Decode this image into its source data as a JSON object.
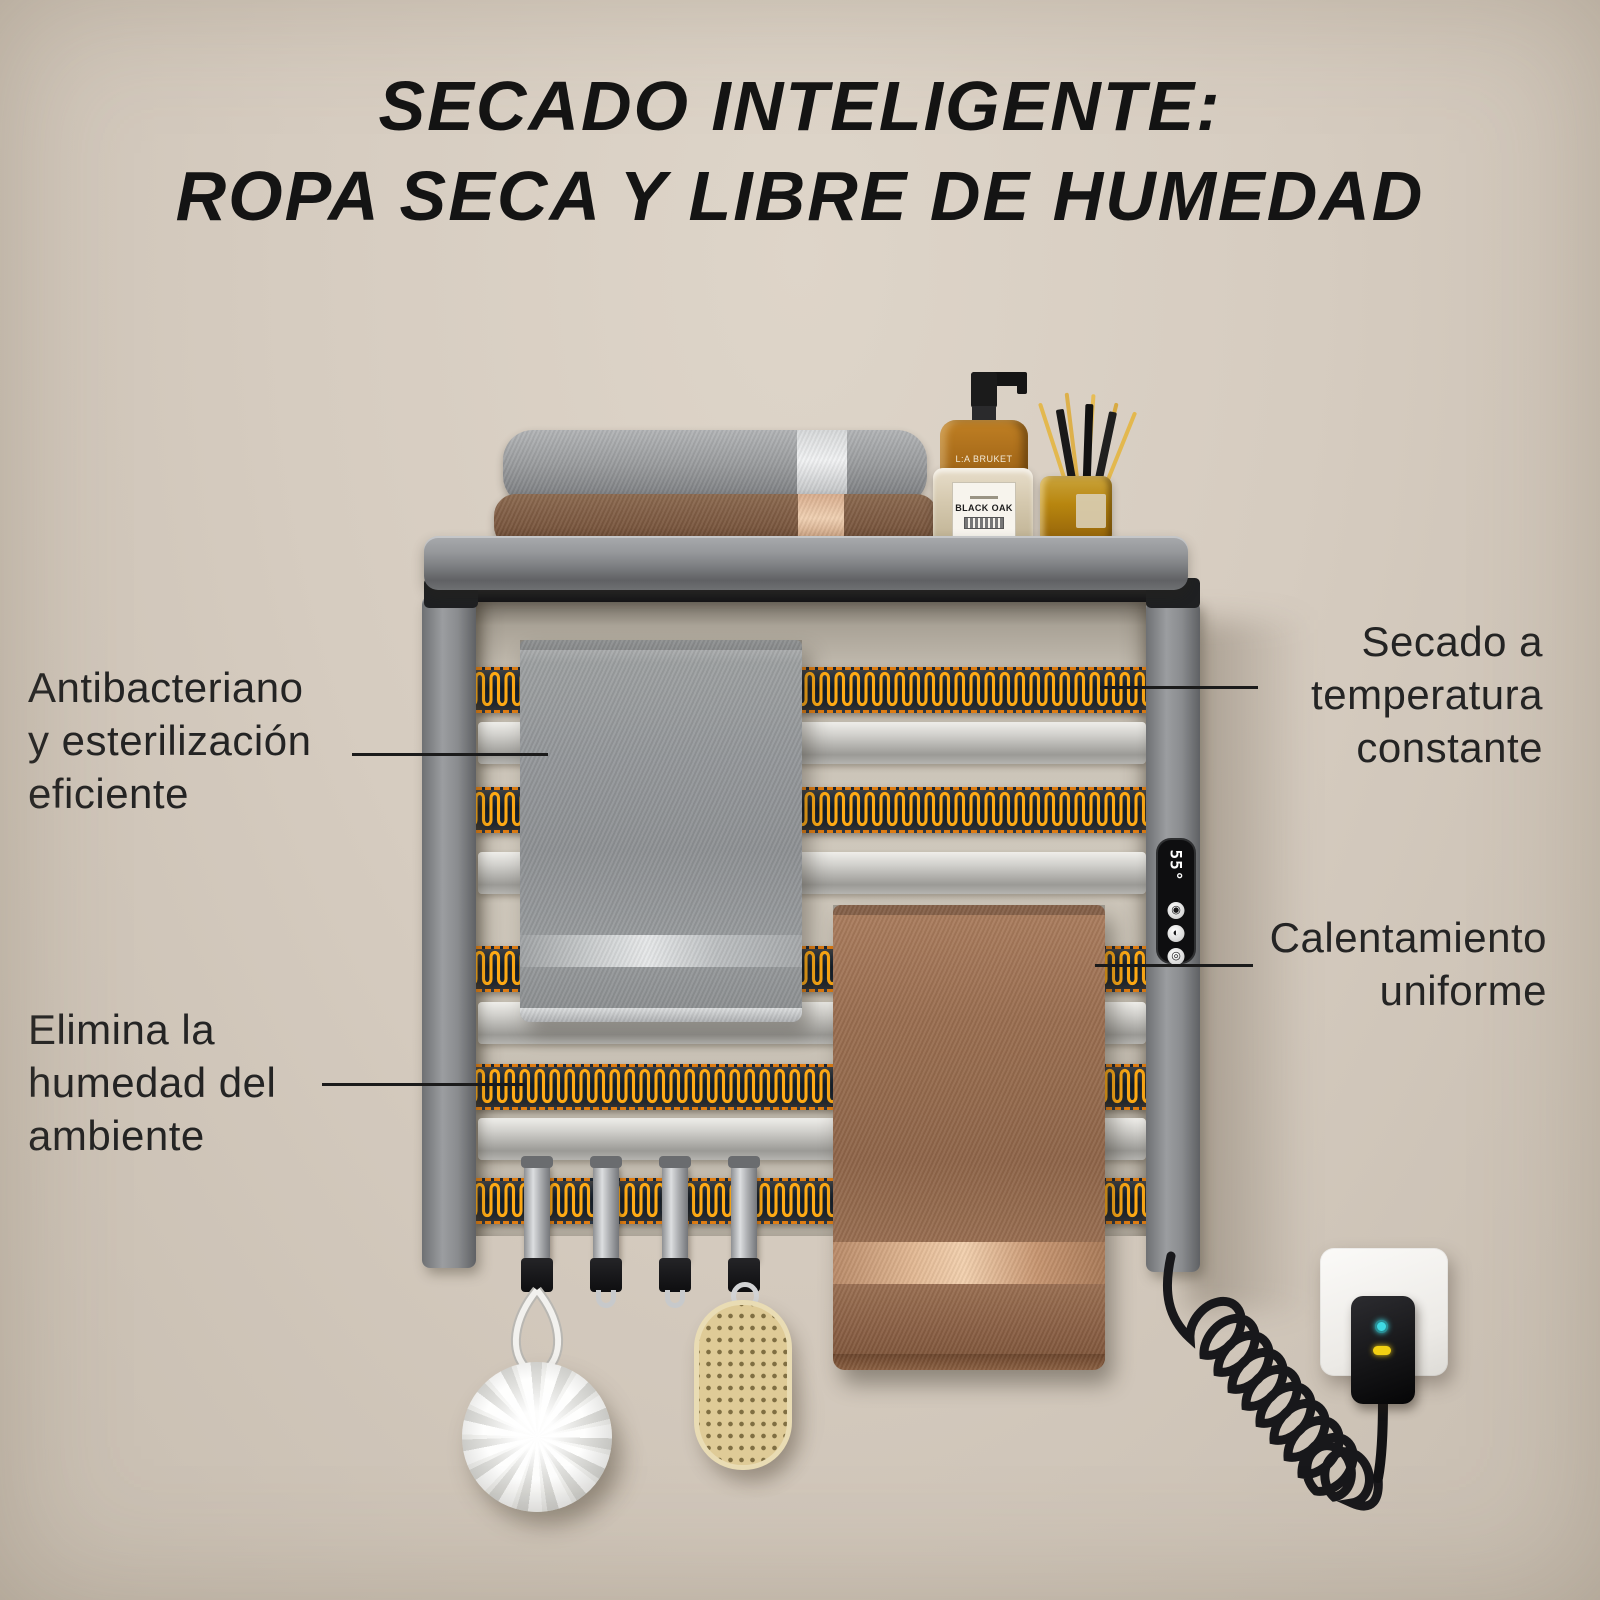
{
  "title": {
    "line1": "SECADO INTELIGENTE:",
    "line2": "ROPA SECA Y LIBRE DE HUMEDAD"
  },
  "callouts": {
    "antibacterial": {
      "line1": "Antibacteriano",
      "line2": "y esterilización",
      "line3": "eficiente"
    },
    "humidity": {
      "line1": "Elimina la",
      "line2": "humedad del",
      "line3": "ambiente"
    },
    "constant_temp": {
      "line1": "Secado a",
      "line2": "temperatura",
      "line3": "constante"
    },
    "uniform_heat": {
      "line1": "Calentamiento",
      "line2": "uniforme"
    }
  },
  "device": {
    "display_value": "55°",
    "icons": [
      "◉",
      "◐",
      "◎"
    ]
  },
  "shelf_items": {
    "bottle_brand": "L:A BRUKET",
    "bottle_label": "BLACK OAK"
  },
  "colors": {
    "background": "#d6ccc0",
    "heating_element": "#ffaa14",
    "heater_bg": "#1b2531",
    "heater_dash": "#e07d12",
    "title_text": "#141414",
    "label_text": "#242424",
    "led_cyan": "#3fd9e3",
    "led_yellow": "#f2d013"
  }
}
